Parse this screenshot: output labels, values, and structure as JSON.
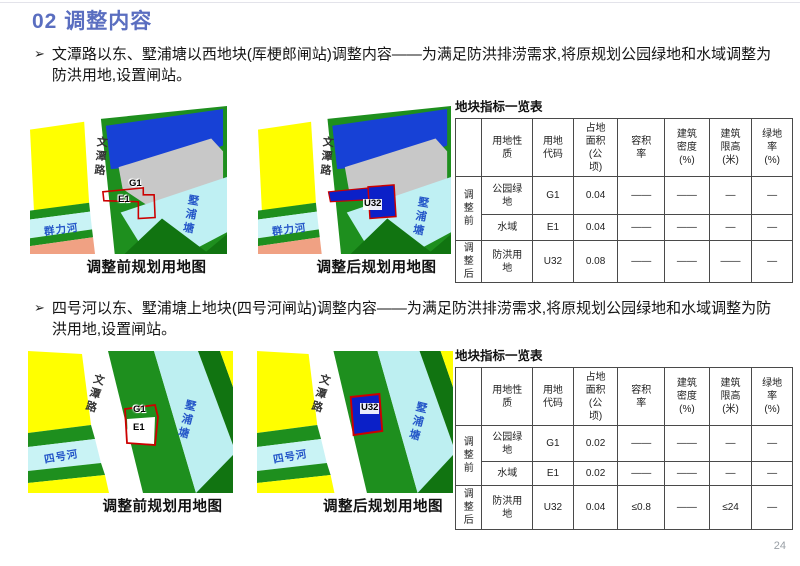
{
  "slide": {
    "title": "02 调整内容",
    "bullet_marker": "➢",
    "page_number": "24",
    "accent_color": "#5A6EC0"
  },
  "section1": {
    "bullet": "文潭路以东、墅浦塘以西地块(厍梗郎闸站)调整内容——为满足防洪排涝需求,将原规划公园绿地和水域调整为防洪用地,设置闸站。",
    "before_caption": "调整前规划用地图",
    "after_caption": "调整后规划用地图",
    "labels": {
      "road": "文潭路",
      "river": "群力河",
      "pond": "墅浦塘",
      "g1": "G1",
      "e1": "E1",
      "u32": "U32"
    },
    "table": {
      "title": "地块指标一览表",
      "col_headers": [
        "用地性\n质",
        "用地\n代码",
        "占地\n面积\n(公\n顷)",
        "容积\n率",
        "建筑\n密度\n(%)",
        "建筑\n限高\n(米)",
        "绿地\n率\n(%)"
      ],
      "group_before": "调\n整\n前",
      "group_after": "调\n整\n后",
      "rows": [
        {
          "nature": "公园绿\n地",
          "code": "G1",
          "area": "0.04",
          "far": "——",
          "density": "——",
          "height": "—",
          "green": "—"
        },
        {
          "nature": "水域",
          "code": "E1",
          "area": "0.04",
          "far": "——",
          "density": "——",
          "height": "—",
          "green": "—"
        },
        {
          "nature": "防洪用\n地",
          "code": "U32",
          "area": "0.08",
          "far": "——",
          "density": "——",
          "height": "——",
          "green": "—"
        }
      ]
    }
  },
  "section2": {
    "bullet": "四号河以东、墅浦塘上地块(四号河闸站)调整内容——为满足防洪排涝需求,将原规划公园绿地和水域调整为防洪用地,设置闸站。",
    "before_caption": "调整前规划用地图",
    "after_caption": "调整后规划用地图",
    "labels": {
      "road": "文潭路",
      "river": "四号河",
      "pond": "墅浦塘",
      "g1": "G1",
      "e1": "E1",
      "u32": "U32"
    },
    "table": {
      "title": "地块指标一览表",
      "col_headers": [
        "用地性\n质",
        "用地\n代码",
        "占地\n面积\n(公\n顷)",
        "容积\n率",
        "建筑\n密度\n(%)",
        "建筑\n限高\n(米)",
        "绿地\n率\n(%)"
      ],
      "group_before": "调\n整\n前",
      "group_after": "调\n整\n后",
      "rows": [
        {
          "nature": "公园绿\n地",
          "code": "G1",
          "area": "0.02",
          "far": "——",
          "density": "——",
          "height": "—",
          "green": "—"
        },
        {
          "nature": "水域",
          "code": "E1",
          "area": "0.02",
          "far": "——",
          "density": "——",
          "height": "—",
          "green": "—"
        },
        {
          "nature": "防洪用\n地",
          "code": "U32",
          "area": "0.04",
          "far": "≤0.8",
          "density": "——",
          "height": "≤24",
          "green": "—"
        }
      ]
    }
  },
  "map_colors": {
    "yellow": "#FFFF00",
    "green": "#1E8F1E",
    "dark_green": "#117411",
    "cyan_water": "#C9F3F5",
    "salmon": "#F0A183",
    "blue_block": "#1741D6",
    "gray_block": "#C8C8C8",
    "u32_blue": "#0B20C8",
    "red_outline": "#CC0000"
  }
}
